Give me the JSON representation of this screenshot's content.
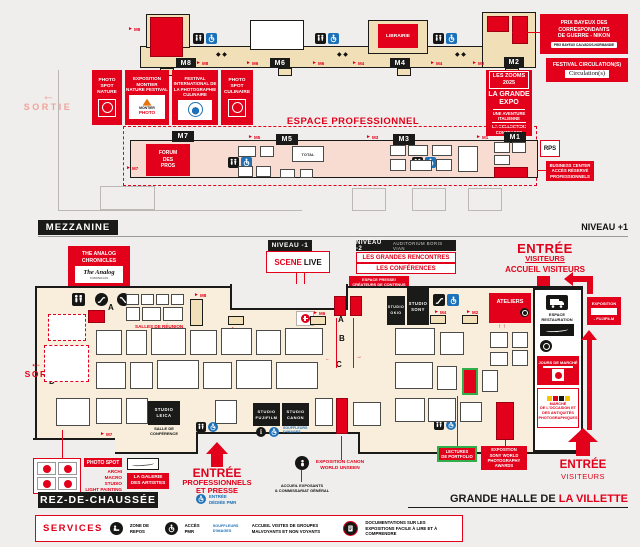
{
  "palette": {
    "red": "#e2001a",
    "black": "#1a1a18",
    "beige": "#f1dfb8",
    "cream": "#f8eedb",
    "pink": "#f8dcd2",
    "blue": "#1d71b8",
    "green": "#2fae4a",
    "salmon": "#f0a29c"
  },
  "icons": {
    "arrow_right": "►",
    "arrow_left": "←",
    "arrow_up": "↑",
    "diamonds": "◆ ◆",
    "info_i": "i",
    "up_pair": "↑ ↑"
  },
  "mezzanine": {
    "section_label": "MEZZANINE",
    "level_label": "NIVEAU +1",
    "sortie_label": "SORTIE",
    "prix_bayeux": {
      "l1": "PRIX BAYEUX DES",
      "l2": "CORRESPONDANTS",
      "l3": "DE GUERRE - NIKON",
      "badge": "PRIX BAYEUX CALVADOS-NORMANDIE"
    },
    "festival_circulations": {
      "label": "FESTIVAL CIRCULATION(S)",
      "logo": "Circulation(s)"
    },
    "librairie_label": "LIBRAIRIE",
    "zooms": {
      "t1": "LES ZOOMS",
      "t2": "2025",
      "e1": "LA GRANDE",
      "e2": "EXPO",
      "s1": "UNE AVENTURE",
      "s2": "ITALIENNE",
      "s3": "LA COLLECTION",
      "s4": "CONTRASTO"
    },
    "photo_spot_nature": {
      "l1": "PHOTO",
      "l2": "SPOT",
      "l3": "NATURE"
    },
    "expo_montier": {
      "l1": "EXPOSITION",
      "l2": "MONTIER",
      "l3": "NATURE FESTIVAL",
      "logo1": "MONTIER",
      "logo2": "PHOTO"
    },
    "festival_culinaire": {
      "l1": "FESTIVAL",
      "l2": "INTERNATIONAL DE",
      "l3": "LA PHOTOGRAPHIE",
      "l4": "CULINAIRE"
    },
    "photo_spot_culinaire": {
      "l1": "PHOTO",
      "l2": "SPOT",
      "l3": "CULINAIRE"
    },
    "espace_pro": {
      "title": "ESPACE PROFESSIONNEL",
      "forum1": "FORUM",
      "forum2": "DES",
      "forum3": "PROS",
      "total_label": "TOTAL",
      "rps": "RPS",
      "biz1": "BUSINESS CENTER",
      "biz2": "ACCÈS RÉSERVÉ",
      "biz3": "PROFESSIONNELS"
    },
    "tags": {
      "m8": "M8",
      "m6": "M6",
      "m4": "M4",
      "m2": "M2",
      "m7": "M7",
      "m5": "M5",
      "m3": "M3",
      "m1": "M1"
    }
  },
  "ground": {
    "section_label": "REZ-DE-CHAUSSÉE",
    "hall_label": {
      "black": "GRANDE HALLE DE",
      "red": "LA VILLETTE"
    },
    "sortie_label": "SORTIE",
    "analog": {
      "l1": "THE ANALOG",
      "l2": "CHRONICLES",
      "logo1": "The Analog",
      "logo2": "CHRONICLES"
    },
    "niveau_moins1": {
      "tag": "NIVEAU -1",
      "scene": "SCENE",
      "live": "LIVE"
    },
    "niveau_moins2": {
      "tag": "NIVEAU -2",
      "tag_sub": "AUDITORIUM BORIS VIAN",
      "line1": "LES GRANDES RENCONTRES",
      "line2": "LES CONFÉRENCES"
    },
    "espace_presse": {
      "l1": "ESPACE PRESSE/",
      "l2": "CRÉATEURS DE CONTENUS"
    },
    "entree_visiteurs_top": {
      "l1": "ENTRÉE",
      "l2": "VISITEURS",
      "l3": "ACCUEIL VISITEURS"
    },
    "ateliers_label": "ATELIERS",
    "studio_sony": {
      "l1": "STUDIO",
      "l2": "SONY"
    },
    "studio_okio": {
      "l1": "STUDIO",
      "l2": "OKIO"
    },
    "studio_leica": {
      "l1": "STUDIO",
      "l2": "LEICA"
    },
    "studio_fujifilm": {
      "l1": "STUDIO",
      "l2": "FUJIFILM"
    },
    "studio_canon": {
      "l1": "STUDIO",
      "l2": "CANON"
    },
    "salle_conference": {
      "l1": "SALLE DE",
      "l2": "CONFÉRENCE"
    },
    "salles_reunion": "SALLES DE RÉUNION",
    "lectures": {
      "l1": "LECTURES",
      "l2": "DE PORTFOLIO"
    },
    "expo_sony": {
      "l1": "EXPOSITION",
      "l2": "SONY WORLD",
      "l3": "PHOTOGRAPHY",
      "l4": "AWARDS"
    },
    "expo_canon": {
      "l1": "EXPOSITION CANON",
      "l2": "WORLD UNSEEN"
    },
    "accueil_exposants": {
      "l1": "ACCUEIL EXPOSANTS",
      "l2": "& COMMISSARIAT GÉNÉRAL"
    },
    "entree_pro": {
      "l1": "ENTRÉE",
      "l2": "PROFESSIONNELS",
      "l3": "ET PRESSE",
      "pmr1": "ENTRÉE",
      "pmr2": "DÉDIÉE PMR"
    },
    "photo_spot": {
      "label": "PHOTO SPOT",
      "s1": "ARCHI",
      "s2": "MACRO",
      "s3": "STUDIO",
      "s4": "LIGHT PAINTING"
    },
    "galerie": {
      "l1": "LA GALERIE",
      "l2": "DES ARTISTES"
    },
    "restauration": {
      "l1": "ESPACE",
      "l2": "RESTAURATION"
    },
    "jours_marche": "JOURS DE MARCHÉ",
    "marche_occasion": {
      "l1": "MARCHÉ",
      "l2": "DE L'OCCASION ET",
      "l3": "DES ANTIQUITÉS",
      "l4": "PHOTOGRAPHIQUES"
    },
    "expo_fujifilm": {
      "l1": "EXPOSITION",
      "l2": "- FUJIFILM"
    },
    "entree_visiteurs_right": {
      "l1": "ENTRÉE",
      "l2": "VISITEURS"
    },
    "markers": {
      "a": "A",
      "b": "B",
      "c": "C",
      "d": "D"
    },
    "souffleurs": {
      "l1": "SOUFFLEURS",
      "l2": "D'IMAGES"
    },
    "services": {
      "title": "SERVICES",
      "i1": "ZONE DE REPOS",
      "i2": "ACCÈS PMR",
      "i3": "ACCUEIL VISITES DE GROUPES MALVOYANTS ET NON VOYANTS",
      "i4": "DOCUMENTATIONS SUR LES EXPOSITIONS FACILE À LIRE ET À COMPRENDRE"
    }
  }
}
